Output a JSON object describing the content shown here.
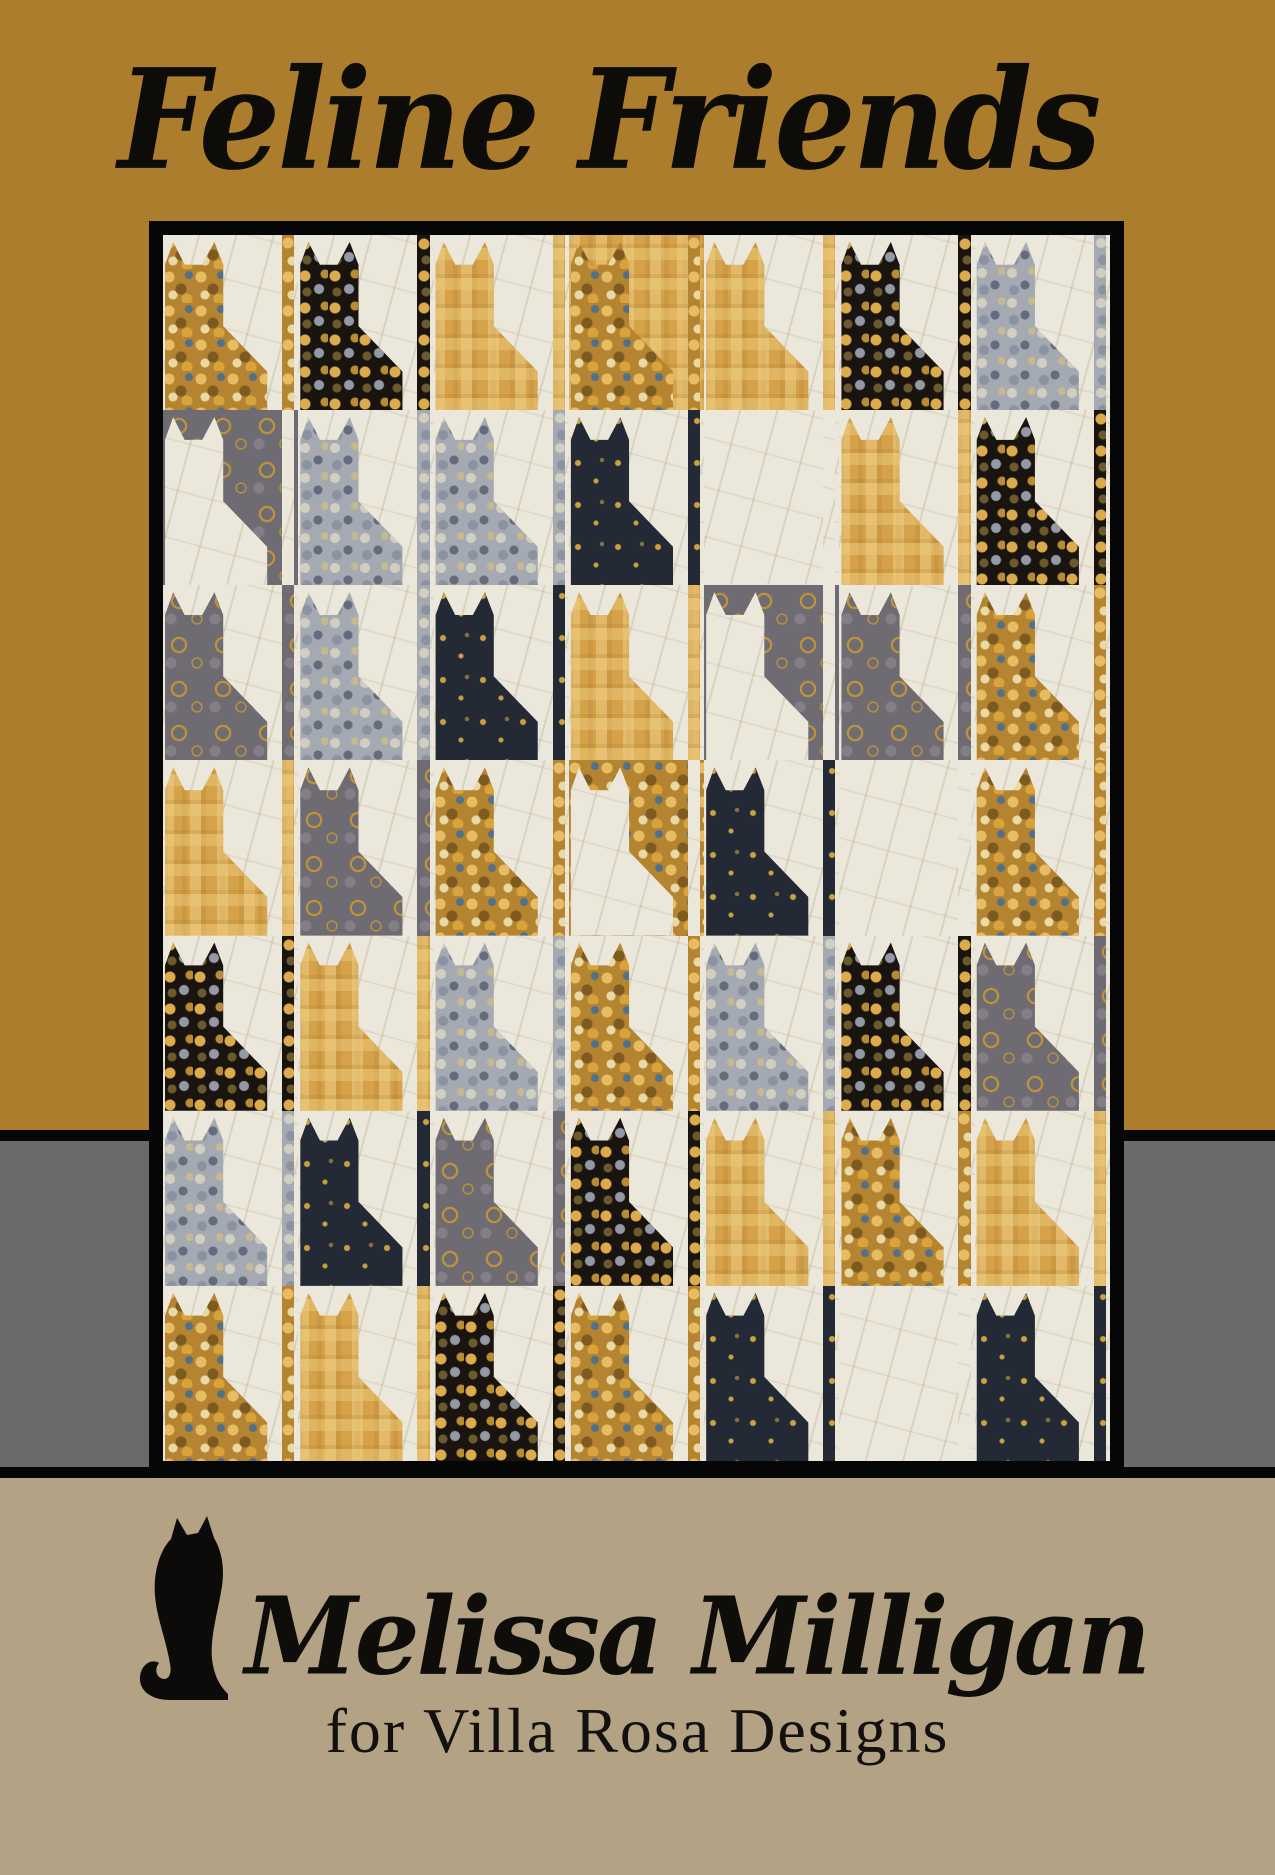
{
  "title": "Feline Friends",
  "brand": {
    "designer": "Melissa Milligan",
    "tagline": "for Villa Rosa Designs",
    "logo": "sitting-cat-silhouette"
  },
  "colors": {
    "top_band": "#ab7d2c",
    "middle_band": "#6a696b",
    "bottom_band": "#b3a284",
    "divider": "#070707",
    "quilt_border": "#060606",
    "text": "#0d0c09"
  },
  "quilt": {
    "rows": 7,
    "cols": 7,
    "fabrics": {
      "A": {
        "name": "gold-pebble-print",
        "base": "#b58431"
      },
      "B": {
        "name": "black-gold-leaf-print",
        "base": "#191410"
      },
      "C": {
        "name": "gold-mosaic-print",
        "base": "#d5a24a"
      },
      "D": {
        "name": "silver-pebble-print",
        "base": "#a4a9b2"
      },
      "E": {
        "name": "pewter-gold-swirl-print",
        "base": "#6f6b72"
      },
      "F": {
        "name": "charcoal-gold-speck-print",
        "base": "#232a36"
      },
      "W": {
        "name": "cream-background",
        "base": "#ebe8db"
      }
    },
    "grid": [
      [
        "A|W",
        "B|W",
        "C|W",
        "A|C",
        "C|W",
        "B|W",
        "D|W"
      ],
      [
        "W|E",
        "D|W",
        "D|W",
        "F|W",
        "W|W",
        "C|W",
        "B|W"
      ],
      [
        "E|W",
        "D|W",
        "F|W",
        "C|W",
        "W|E",
        "E|W",
        "A|W"
      ],
      [
        "C|W",
        "E|W",
        "A|W",
        "W|A",
        "F|W",
        "W|W",
        "A|W"
      ],
      [
        "B|W",
        "C|W",
        "D|W",
        "A|W",
        "D|W",
        "B|W",
        "E|W"
      ],
      [
        "D|W",
        "F|W",
        "E|W",
        "B|W",
        "C|W",
        "A|W",
        "C|W"
      ],
      [
        "A|W",
        "C|W",
        "B|W",
        "A|W",
        "F|W",
        "W|W",
        "F|W"
      ]
    ]
  }
}
